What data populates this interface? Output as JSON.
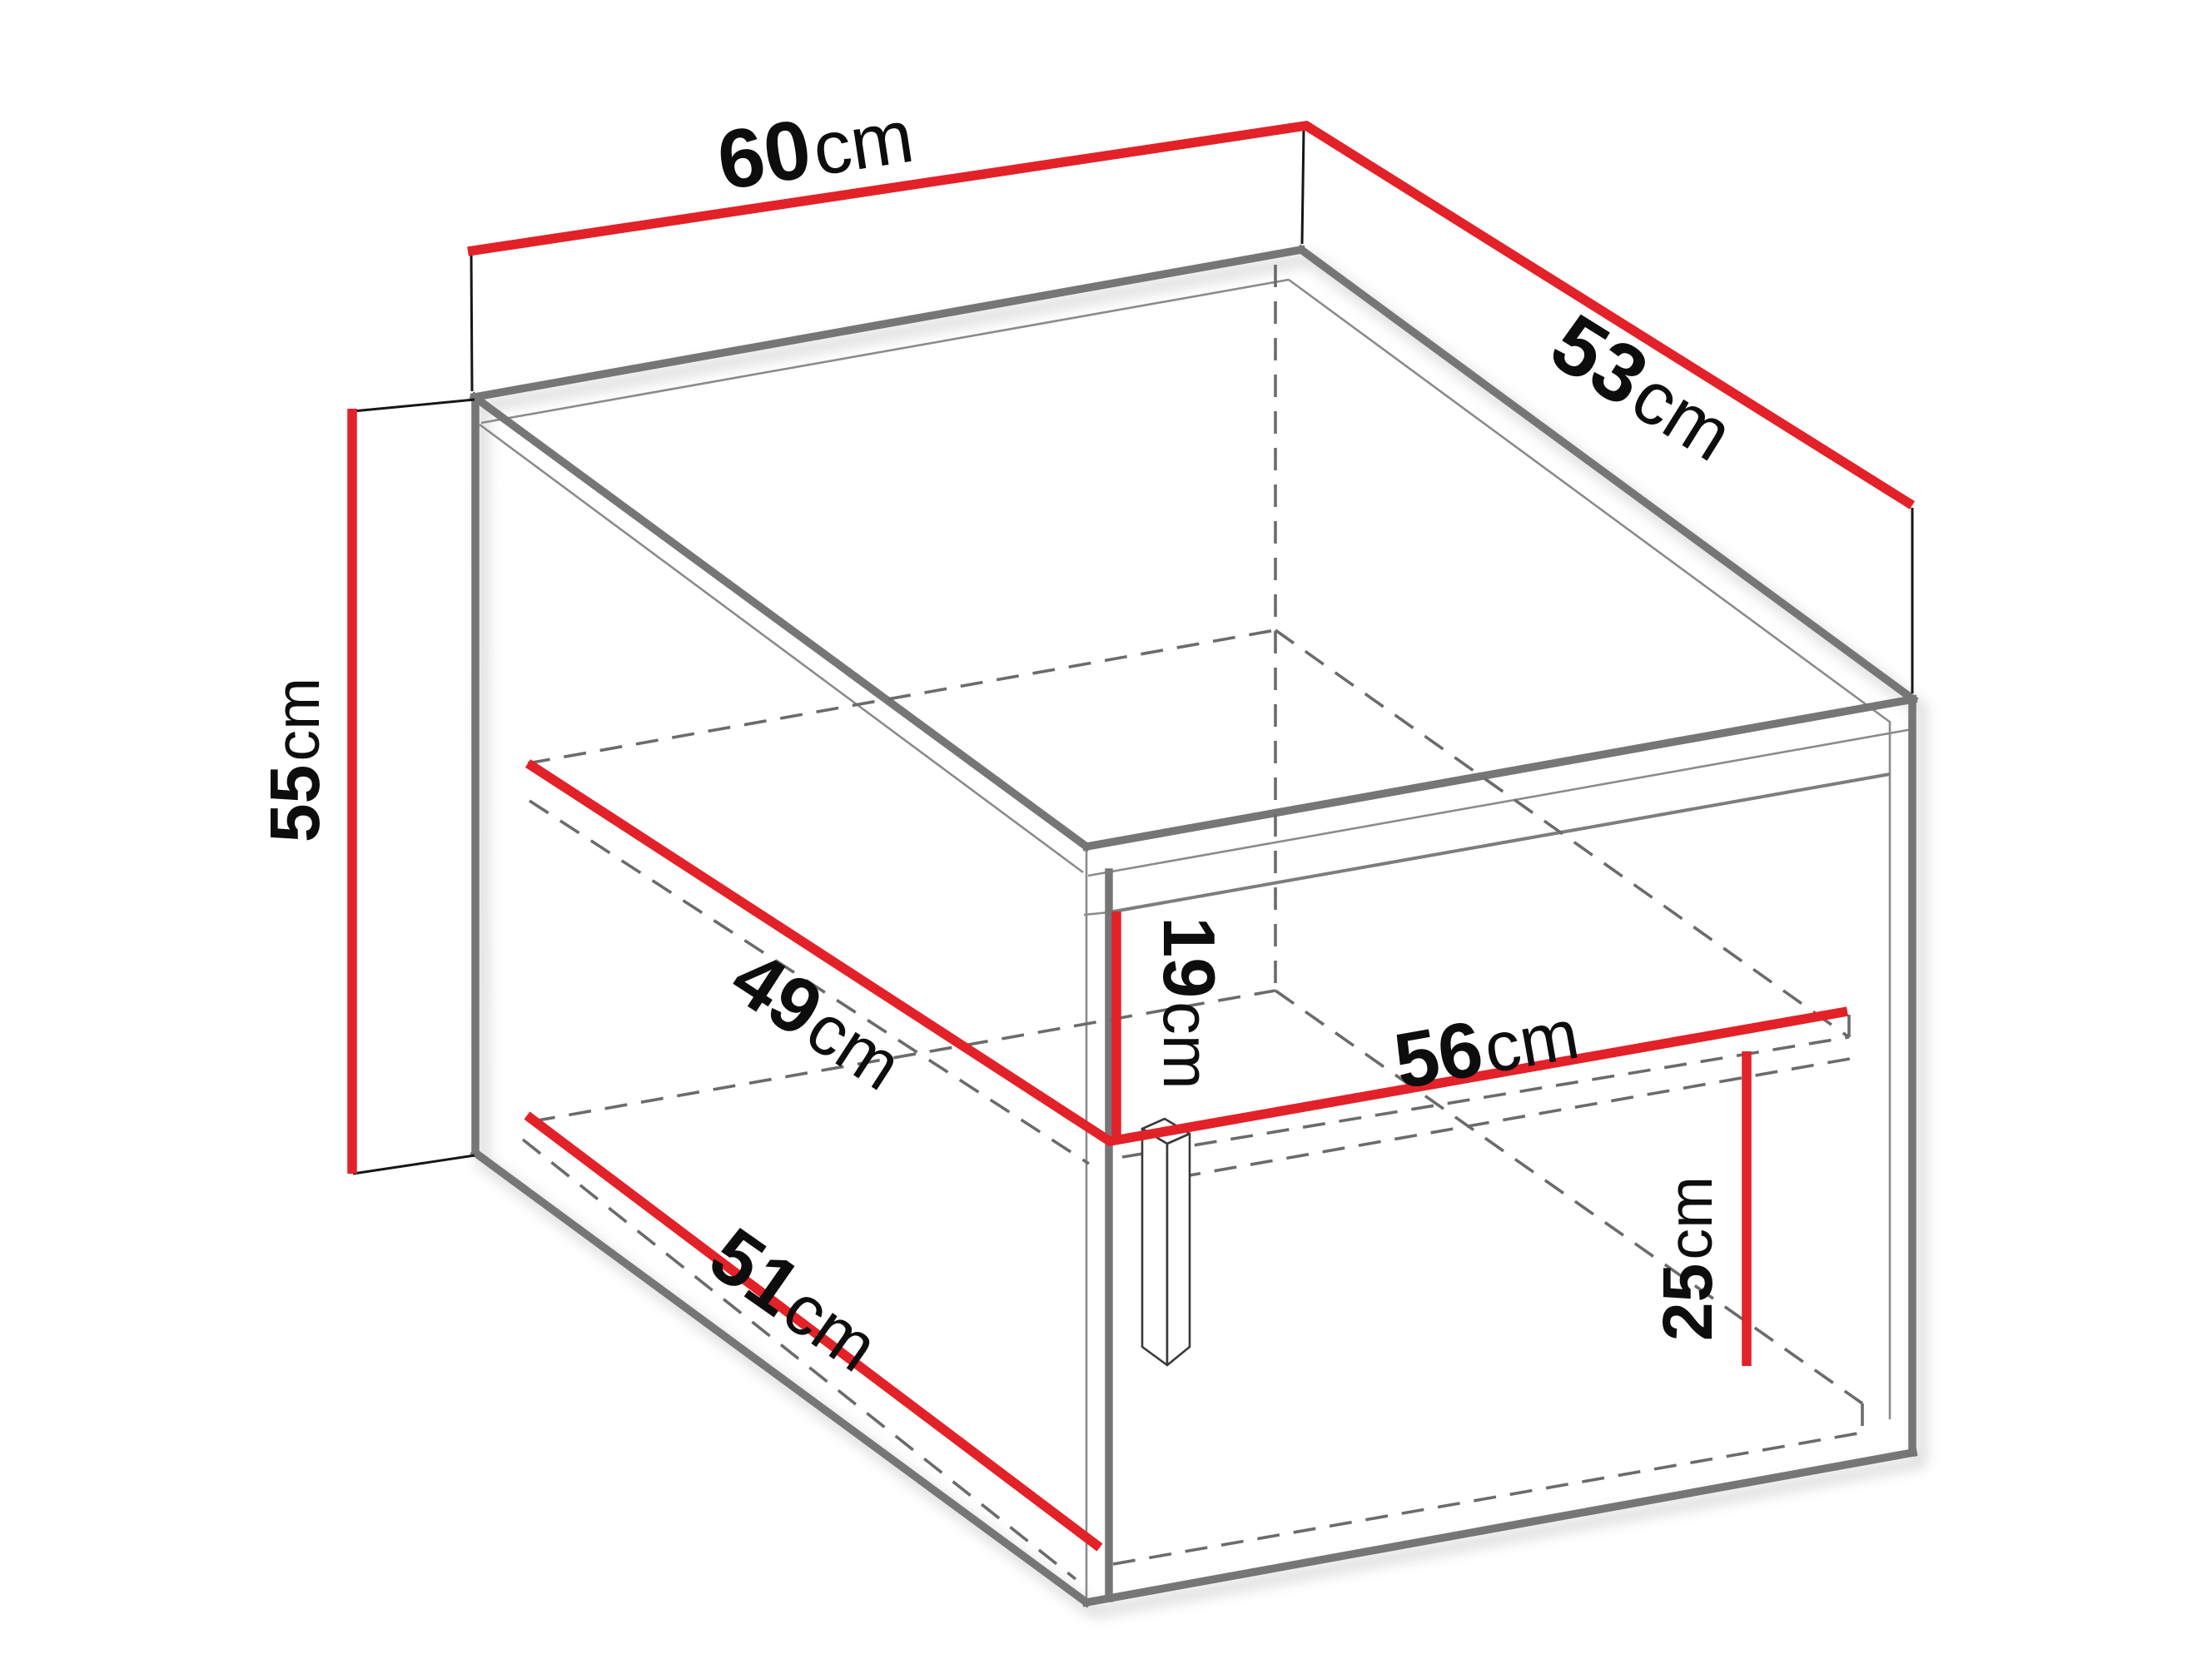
{
  "diagram": {
    "type": "furniture-dimension-diagram",
    "subject": "isometric cabinet technical drawing with dimension lines",
    "background": "#ffffff",
    "colors": {
      "dimension_red": "#e32128",
      "edge_gray": "#767676",
      "thin_gray": "#8b8b8b",
      "hidden_dash_gray": "#6b6b6b",
      "extension_black": "#161616",
      "text_black": "#0d0d0d"
    },
    "measurements": [
      {
        "id": "outer-width",
        "value": "60",
        "unit": "cm",
        "placement": "top-left outer edge"
      },
      {
        "id": "outer-depth",
        "value": "53",
        "unit": "cm",
        "placement": "top-right outer edge"
      },
      {
        "id": "outer-height",
        "value": "55",
        "unit": "cm",
        "placement": "left vertical edge"
      },
      {
        "id": "shelf-depth",
        "value": "49",
        "unit": "cm",
        "placement": "interior shelf, left edge"
      },
      {
        "id": "opening-height",
        "value": "19",
        "unit": "cm",
        "placement": "front opening, vertical"
      },
      {
        "id": "interior-width",
        "value": "56",
        "unit": "cm",
        "placement": "shelf front edge"
      },
      {
        "id": "bottom-depth",
        "value": "51",
        "unit": "cm",
        "placement": "interior bottom, left edge"
      },
      {
        "id": "lower-compartment-height",
        "value": "25",
        "unit": "cm",
        "placement": "lower compartment, vertical"
      }
    ]
  }
}
